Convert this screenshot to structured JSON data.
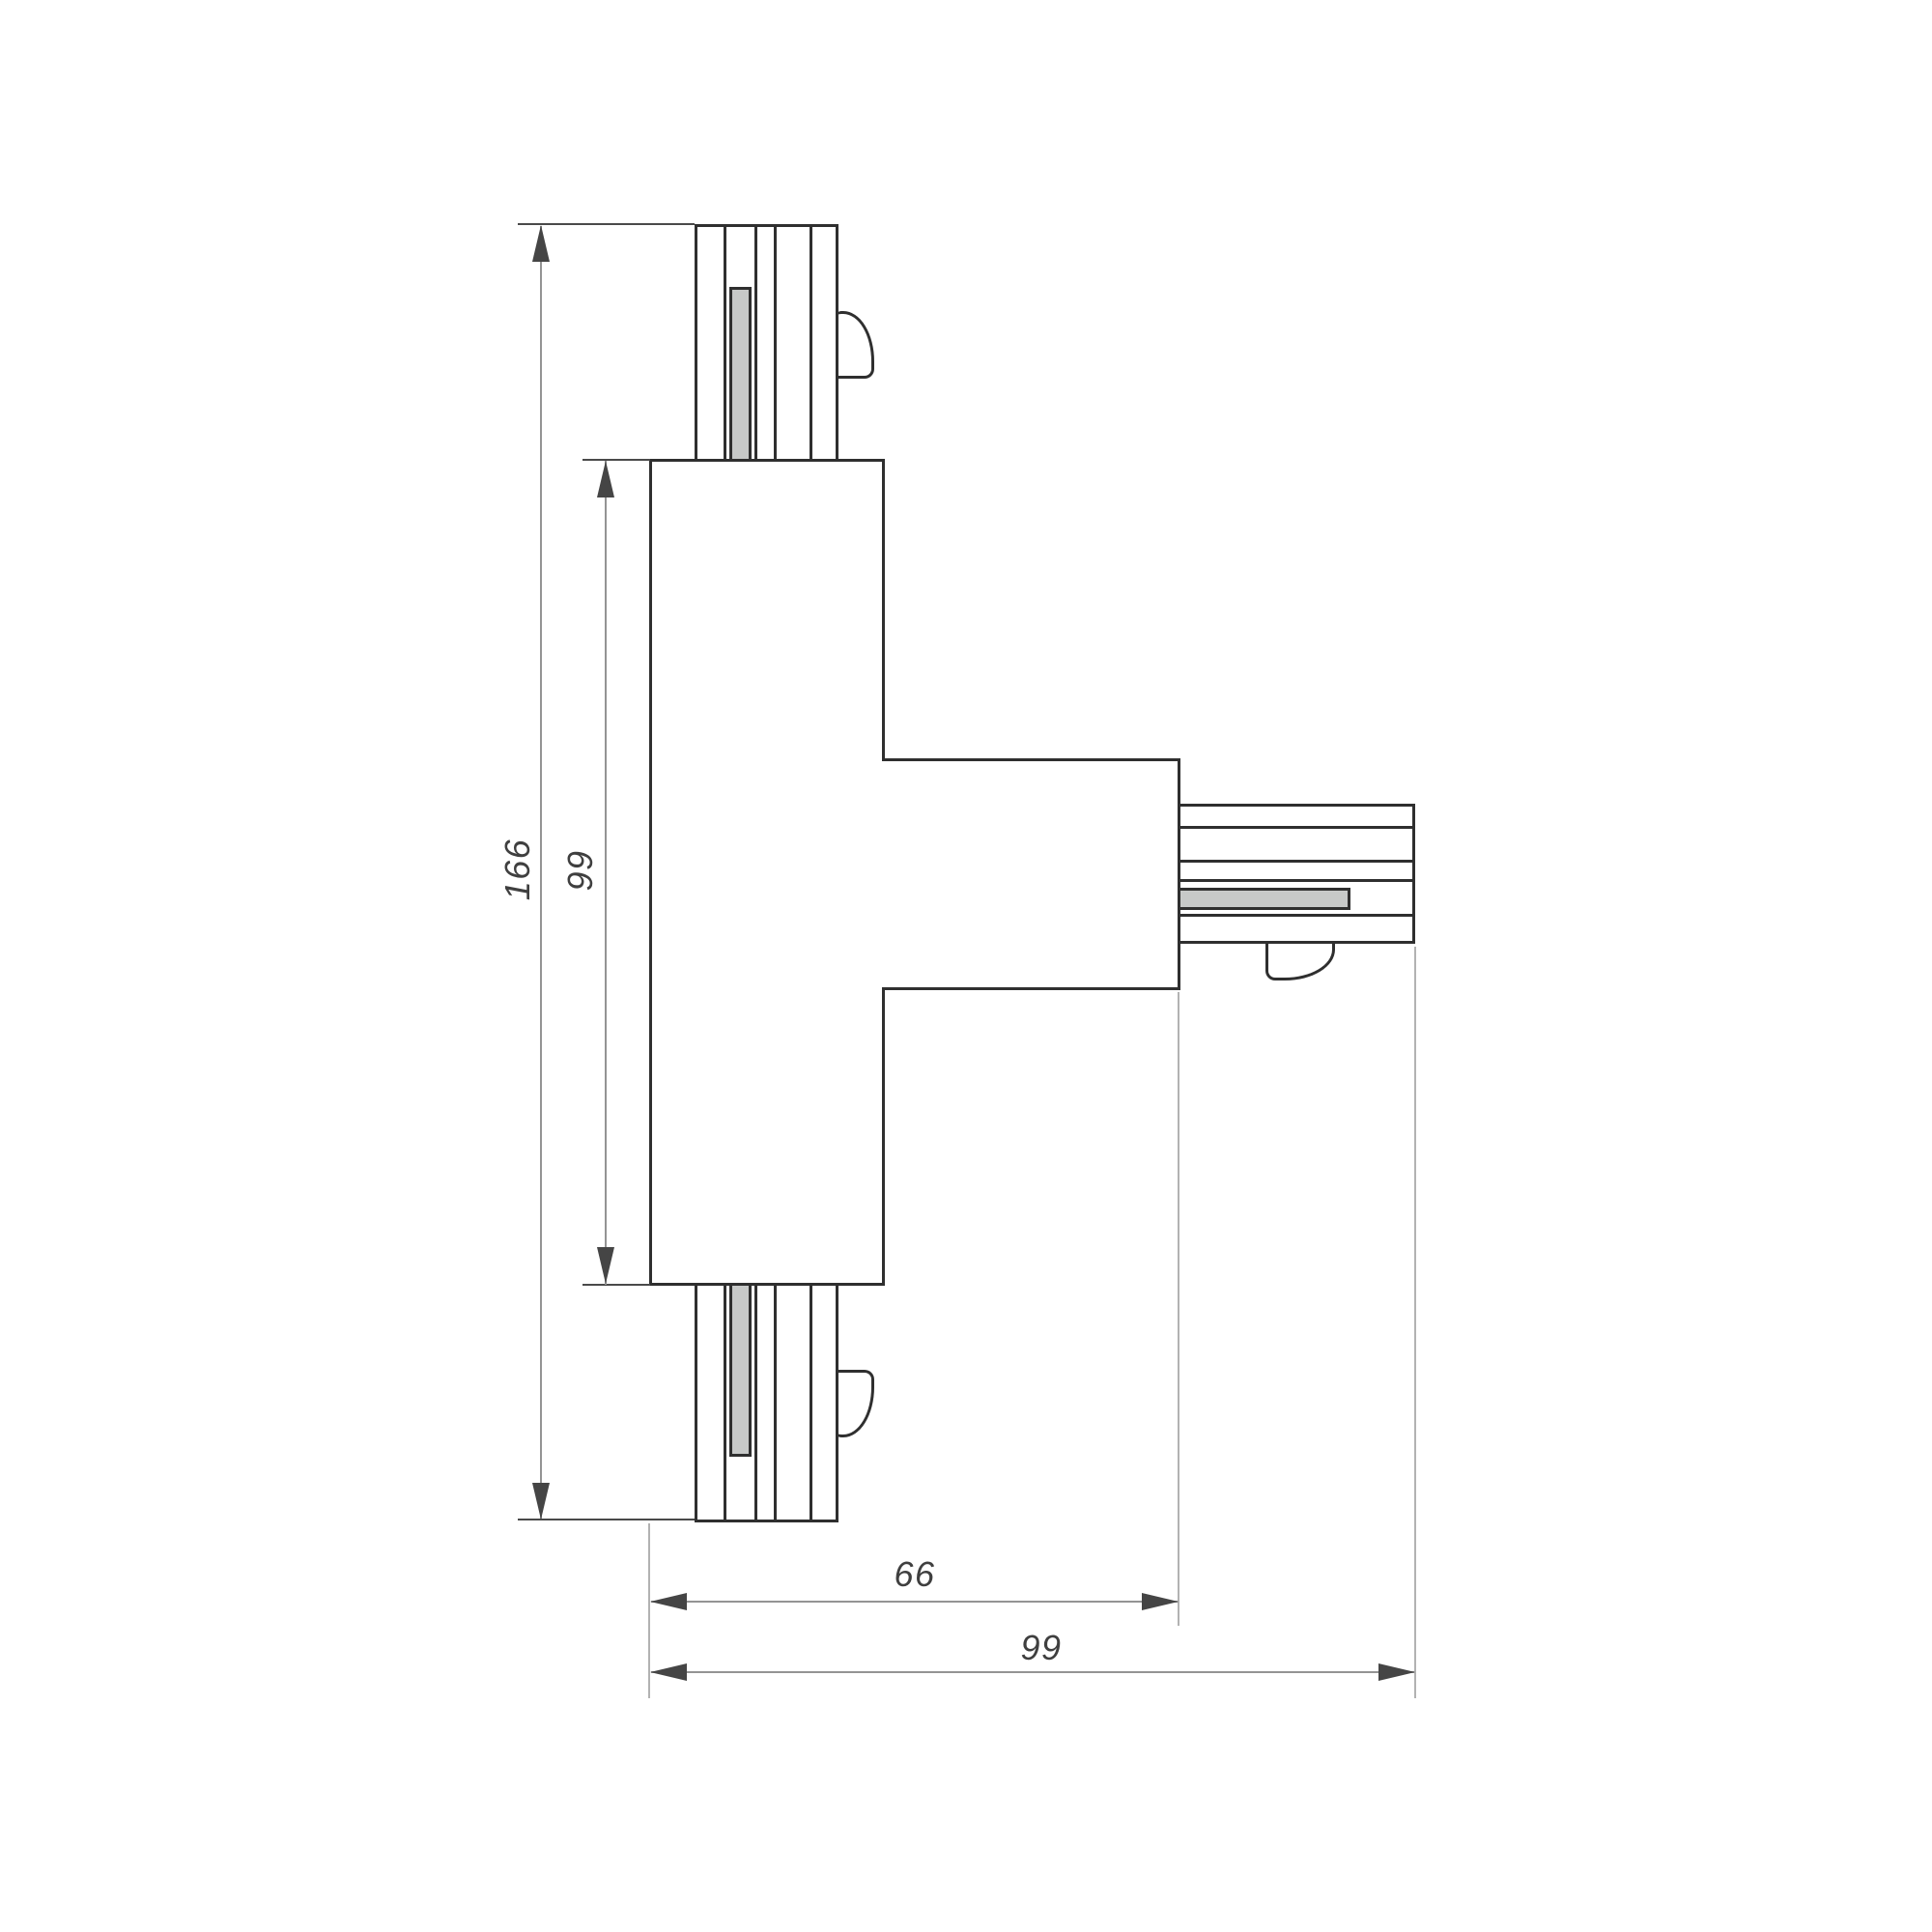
{
  "drawing": {
    "type": "engineering-dimension-drawing",
    "subject": "T-shaped track connector, plan view",
    "dimension_labels": {
      "overall_height": "166",
      "body_height": "99",
      "arm_reach": "66",
      "overall_width": "99"
    },
    "colors": {
      "background": "#ffffff",
      "part_outline": "#2f2f2f",
      "contact_strip_fill": "#c7c9c8",
      "dimension_line": "#949494",
      "extension_line_dark": "#4a4a4a",
      "extension_line_light": "#b2b2b2",
      "arrowhead": "#454545",
      "label_text": "#3f3f3f"
    }
  }
}
